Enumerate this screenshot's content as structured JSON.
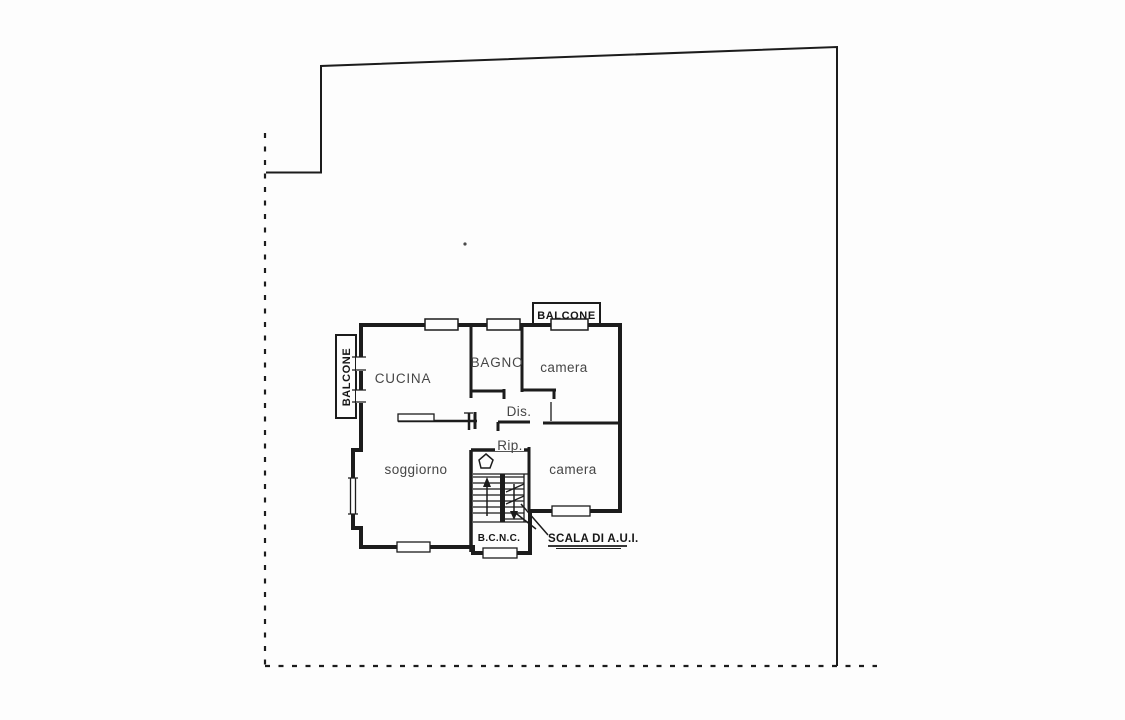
{
  "colors": {
    "background": "#fdfdfd",
    "line": "#1c1c1c",
    "room_label_text": "#464646",
    "bold_label_text": "#161616"
  },
  "floor_plan": {
    "balcony_top_label": "BALCONE",
    "balcony_left_label": "BALCONE",
    "rooms": {
      "kitchen": "CUCINA",
      "bathroom": "BAGNO",
      "bedroom_upper": "camera",
      "disimpegno": "Dis.",
      "ripostiglio": "Rip.",
      "living_room": "soggiorno",
      "bedroom_lower": "camera",
      "stairwell_bcnc": "B.C.N.C.",
      "stairs_annotation": "SCALA DI A.U.I."
    }
  }
}
